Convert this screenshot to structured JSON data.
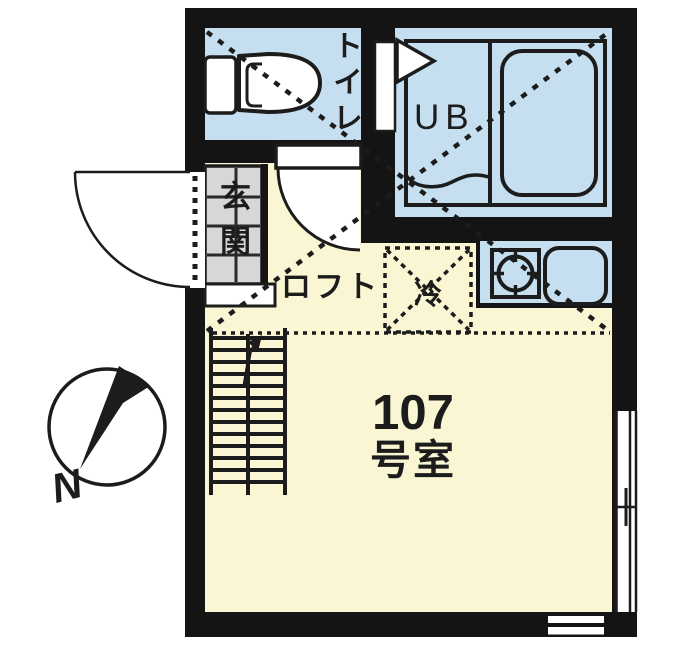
{
  "floor_plan": {
    "title": "apartment-unit-floor-plan",
    "room_number": {
      "line1": "107",
      "line2": "号室"
    },
    "labels": {
      "toilet": "トイレ",
      "unit_bath": "UB",
      "entrance": "玄関",
      "loft": "ロフト",
      "refrigerator": "冷"
    },
    "compass": {
      "north": "N"
    },
    "features": [
      "toilet-room",
      "unit-bath-with-tub",
      "entrance-genkan",
      "loft-area-dashed",
      "refrigerator-space",
      "kitchen-counter-burner-sink",
      "stairs-to-loft",
      "swing-doors",
      "windows",
      "north-compass"
    ],
    "colors": {
      "wall": "#141414",
      "water_room_fill": "#c5dff1",
      "floor_fill": "#faf6d3",
      "entrance_tile_fill": "#d7d7d7",
      "outline": "#1c1c1c",
      "background": "#ffffff"
    }
  }
}
